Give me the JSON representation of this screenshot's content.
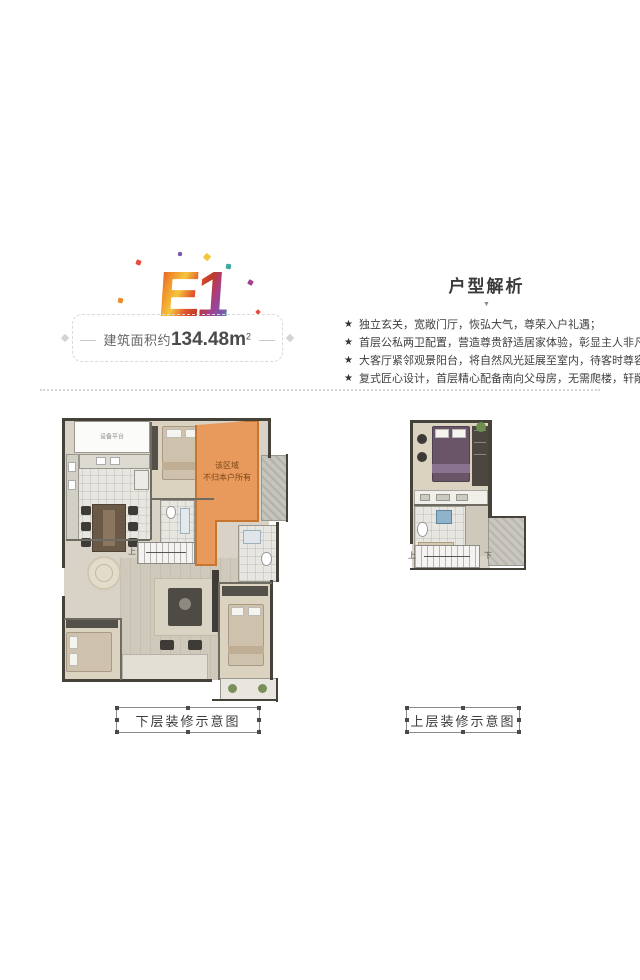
{
  "logo": {
    "text": "E1"
  },
  "area": {
    "prefix": "建筑面积约",
    "value": "134.48",
    "unit": "m",
    "sup": "2"
  },
  "analysis": {
    "title": "户型解析",
    "caret": "▼",
    "star": "★",
    "bullets": [
      "独立玄关，宽敞门厅，恢弘大气，尊荣入户礼遇；",
      "首层公私两卫配置，营造尊贵舒适居家体验，彰显主人非凡气宇；",
      "大客厅紧邻观景阳台，将自然风光延展至室内，待客时尊容大气；",
      "复式匠心设计，首层精心配备南向父母房，无需爬楼，轩敞朗阔。"
    ]
  },
  "plans": {
    "lower": {
      "caption": "下层装修示意图",
      "not_owned_line1": "该区域",
      "not_owned_line2": "不归本户所有",
      "stair_up": "上",
      "equipment": "设备平台"
    },
    "upper": {
      "caption": "上层装修示意图",
      "stair_up": "上",
      "stair_down": "下"
    }
  },
  "colors": {
    "not_owned_fill": "#E89A5C",
    "not_owned_border": "#C8762E",
    "wall": "#454339",
    "floor_wood": "#D9D3C7",
    "floor_tile": "#E8E6E1"
  }
}
